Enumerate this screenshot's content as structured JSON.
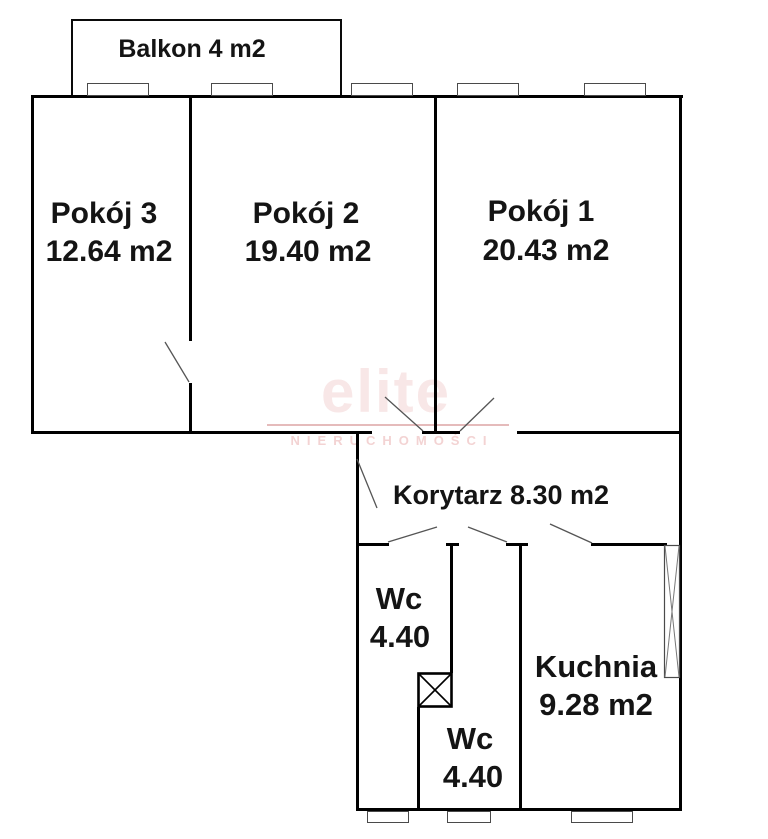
{
  "watermark": {
    "brand": "elite",
    "subtitle": "NIERUCHOMOŚCI"
  },
  "balcony": {
    "label": "Balkon 4 m2"
  },
  "rooms": {
    "pokoj3": {
      "name": "Pokój 3",
      "area": "12.64 m2"
    },
    "pokoj2": {
      "name": "Pokój 2",
      "area": "19.40 m2"
    },
    "pokoj1": {
      "name": "Pokój 1",
      "area": "20.43 m2"
    },
    "korytarz": {
      "label": "Korytarz 8.30 m2"
    },
    "wc_top": {
      "name": "Wc",
      "area": "4.40"
    },
    "wc_bottom": {
      "name": "Wc",
      "area": "4.40"
    },
    "kuchnia": {
      "name": "Kuchnia",
      "area": "9.28 m2"
    }
  },
  "colors": {
    "wall": "#000000",
    "window_outline": "#4a4a4a",
    "door_line": "#555555",
    "watermark_text": "#f8e7e7",
    "watermark_line": "#e5bbbb"
  }
}
